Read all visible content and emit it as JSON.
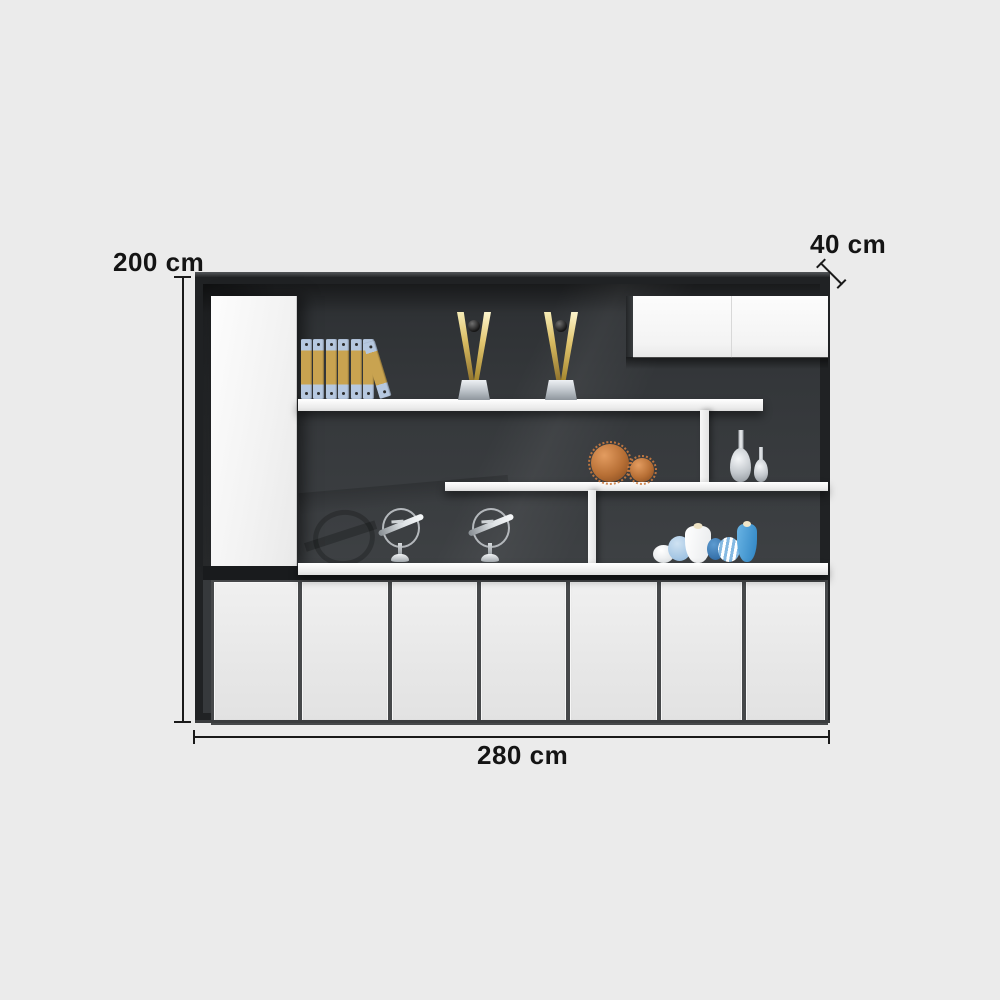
{
  "annotations": {
    "height_label": "200 cm",
    "depth_label": "40 cm",
    "width_label": "280 cm",
    "line_color": "#1a1a1a",
    "text_color": "#141414"
  },
  "cabinet": {
    "description": "black and white office display cabinet with open shelves",
    "frame_color": "#202224",
    "back_panel_color": "#36393c",
    "door_color": "#efefef",
    "shelf_color": "#f5f5f5",
    "lower_doors": {
      "count": 7
    },
    "wall_cabinet": {
      "door_count": 2
    },
    "decor": {
      "binders": {
        "standing_count": 6,
        "leaning_count": 1,
        "spine_color": "#b6c8e0",
        "label_color": "#c9a350"
      },
      "trophies": {
        "count": 2,
        "color": "#d8ba60",
        "base_color": "#bcc2c8"
      },
      "spike_balls": {
        "count": 2,
        "color": "#b76f35"
      },
      "silver_vases": {
        "count": 2,
        "color": "#c3c8cd"
      },
      "airplane_models": {
        "count": 2,
        "color": "#b4b8bc"
      },
      "blue_decor_pieces": {
        "count": 6,
        "colors": [
          "#ffffff",
          "#8fb8dd",
          "#e8eaec",
          "#2a649e",
          "#85b9e2",
          "#2f85c4"
        ]
      }
    }
  }
}
